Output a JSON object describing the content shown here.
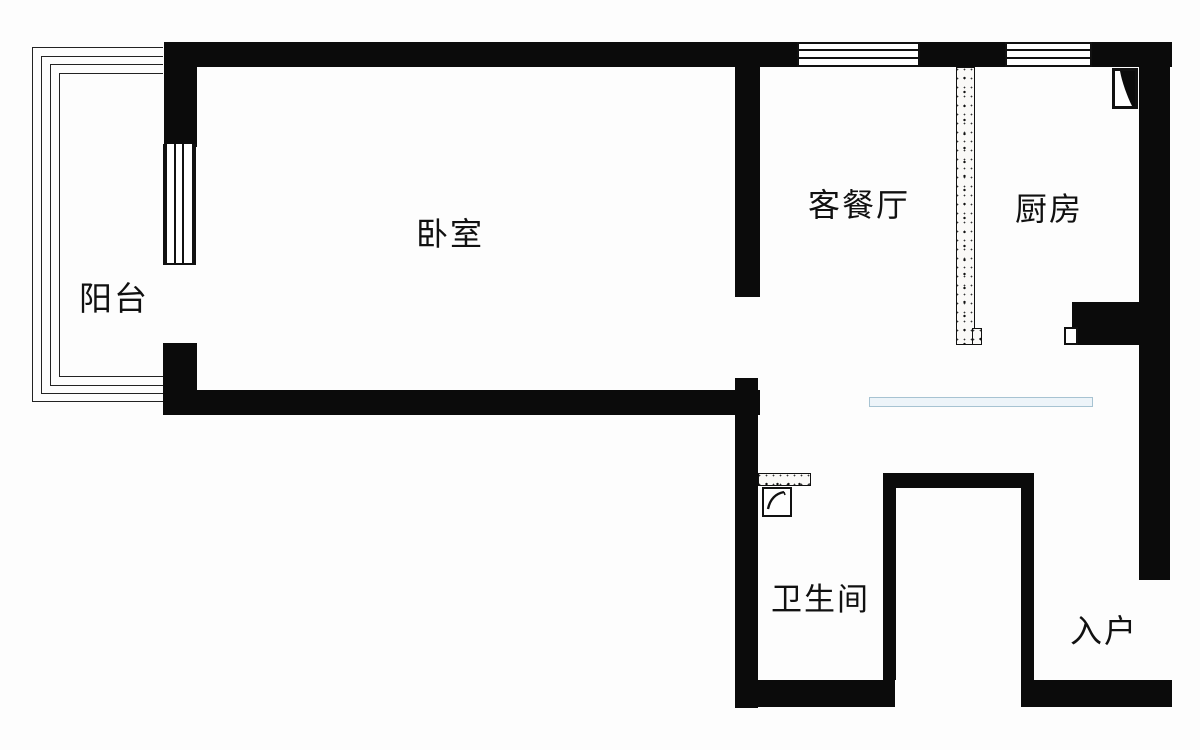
{
  "rooms": {
    "balcony": {
      "label": "阳台"
    },
    "bedroom": {
      "label": "卧室"
    },
    "living_dining": {
      "label": "客餐厅"
    },
    "kitchen": {
      "label": "厨房"
    },
    "bathroom": {
      "label": "卫生间"
    },
    "entry": {
      "label": "入户"
    }
  },
  "colors": {
    "wall": "#0b0b0b",
    "background": "#fdfdfd",
    "text": "#111111",
    "bay_window_fill": "#edf4f9",
    "bay_window_border": "#a7c3d2"
  }
}
